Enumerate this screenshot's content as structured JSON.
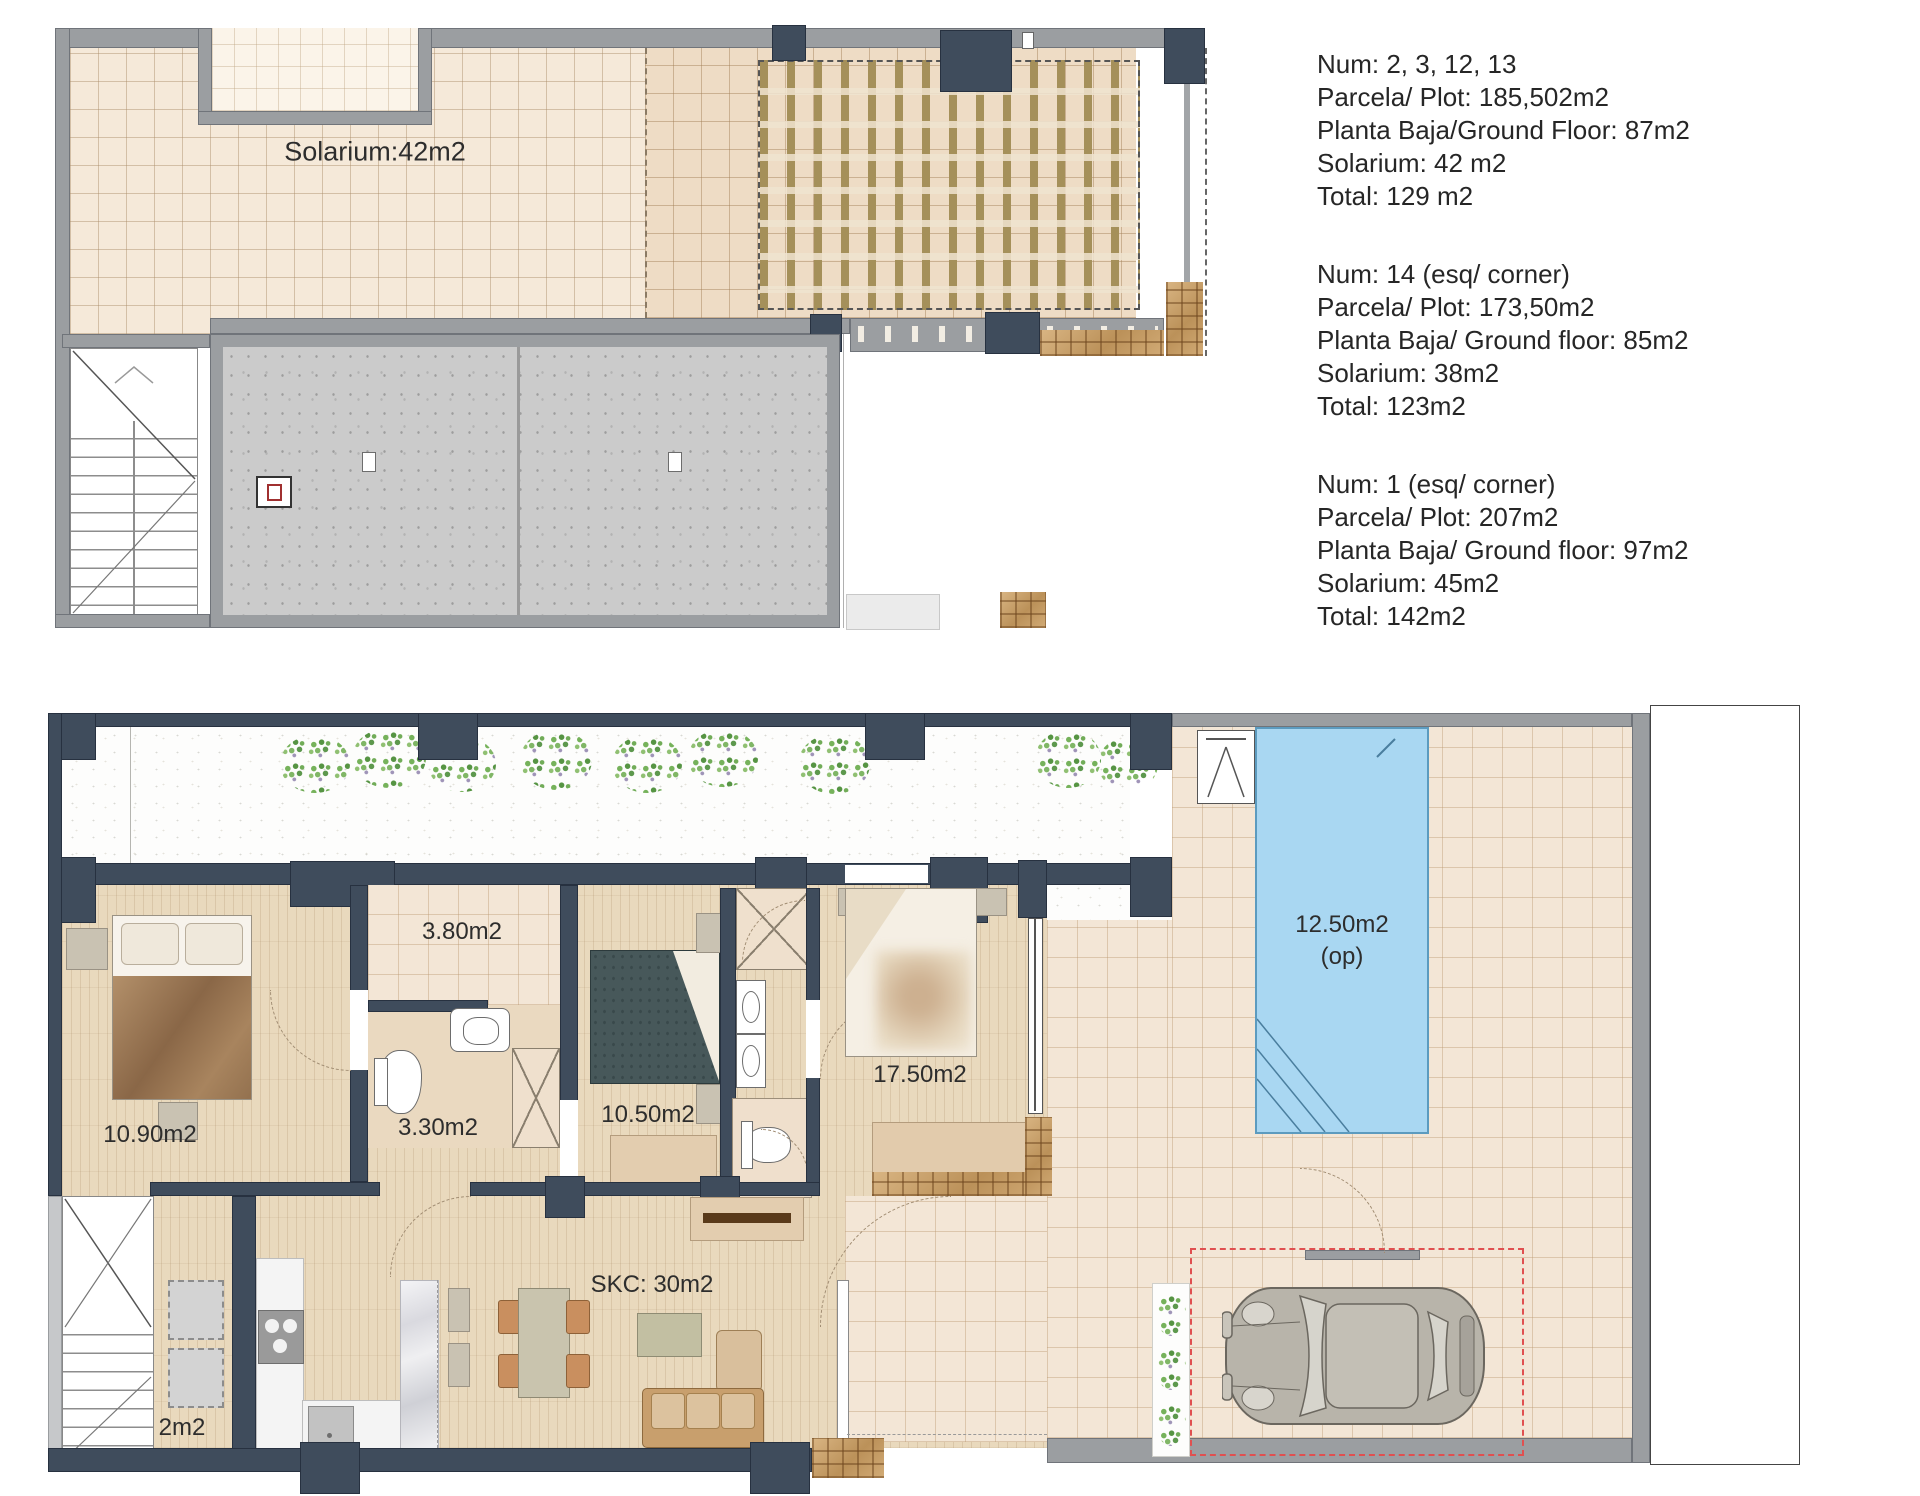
{
  "info_panel": {
    "units": [
      {
        "lines": [
          "Num: 2, 3, 12, 13",
          "Parcela/ Plot: 185,502m2",
          "Planta Baja/Ground Floor: 87m2",
          "Solarium: 42 m2",
          "Total: 129 m2"
        ]
      },
      {
        "lines": [
          "Num: 14 (esq/ corner)",
          "Parcela/ Plot: 173,50m2",
          "Planta Baja/ Ground floor: 85m2",
          "Solarium: 38m2",
          "Total: 123m2"
        ]
      },
      {
        "lines": [
          "Num: 1 (esq/ corner)",
          "Parcela/ Plot: 207m2",
          "Planta Baja/ Ground floor: 97m2",
          "Solarium: 45m2",
          "Total: 142m2"
        ]
      }
    ]
  },
  "solarium_plan": {
    "label": "Solarium:42m2"
  },
  "ground_plan": {
    "rooms": {
      "entry_patio": "3.80m2",
      "bathroom": "3.30m2",
      "bedroom_left": "10.90m2",
      "bedroom_middle": "10.50m2",
      "bedroom_right": "17.50m2",
      "living_kitchen": "SKC: 30m2",
      "pantry": "2m2",
      "pool": "12.50m2",
      "pool_note": "(op)"
    }
  },
  "colors": {
    "wall_navy": "#3f4c5c",
    "wall_gray": "#9b9ea1",
    "pool_blue": "#a9d7f2",
    "parking_red": "#e05050",
    "tile_beige": "#f3e6d6",
    "wood_floor": "#e9d9bd",
    "pergola_slat": "#a5905a",
    "concrete": "#cbcbcb",
    "brick": "#cda46f"
  }
}
